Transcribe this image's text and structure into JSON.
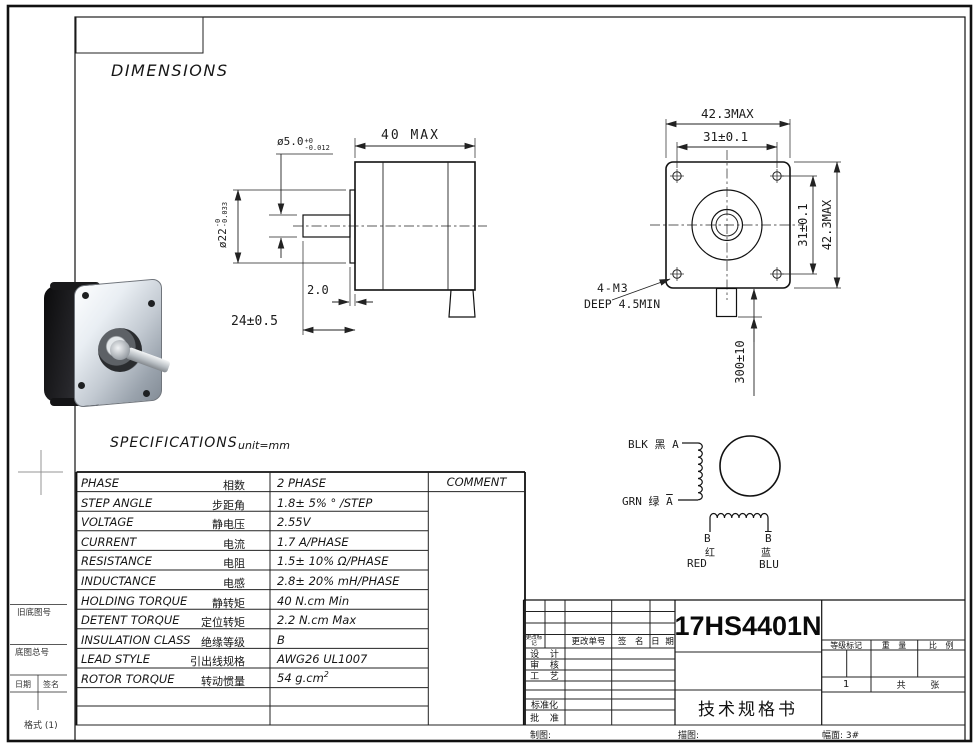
{
  "page": {
    "dimensions_title": "DIMENSIONS",
    "specifications_title": "SPECIFICATIONS",
    "unit_label": "unit=mm",
    "line_color": "#111111"
  },
  "margin": {
    "old_base_no": "旧底图号",
    "base_total_no": "底图总号",
    "date": "日期",
    "sign": "签名",
    "format": "格式 (1)"
  },
  "side_view": {
    "shaft_dia": "ø5.0",
    "shaft_dia_tol_up": "+0",
    "shaft_dia_tol_dn": "-0.012",
    "body_length": "40 MAX",
    "boss_dia": "ø22",
    "boss_dia_tol_up": "-0",
    "boss_dia_tol_dn": "-0.033",
    "boss_height": "2.0",
    "shaft_length": "24±0.5"
  },
  "front_view": {
    "width_max": "42.3MAX",
    "hole_pitch_h": "31±0.1",
    "hole_pitch_v": "31±0.1",
    "height_max": "42.3MAX",
    "lead_length": "300±10",
    "mount_hole": "4-M3",
    "mount_depth": "DEEP 4.5MIN"
  },
  "wiring": {
    "phase_a": "BLK 黑 A",
    "grn_label": "GRN 绿",
    "grn_phase": "A",
    "b_label": "B",
    "b_bar_label": "B",
    "b_cn": "红",
    "b_bar_cn": "蓝",
    "b_en": "RED",
    "b_bar_en": "BLU"
  },
  "spec_table": {
    "comment_header": "COMMENT",
    "rows": [
      {
        "en": "PHASE",
        "cn": "相数",
        "value": "2  PHASE"
      },
      {
        "en": "STEP ANGLE",
        "cn": "步距角",
        "value": "1.8± 5% ° /STEP"
      },
      {
        "en": "VOLTAGE",
        "cn": "静电压",
        "value": "2.55V"
      },
      {
        "en": "CURRENT",
        "cn": "电流",
        "value": "1.7 A/PHASE"
      },
      {
        "en": "RESISTANCE",
        "cn": "电阻",
        "value": "1.5± 10%  Ω/PHASE"
      },
      {
        "en": "INDUCTANCE",
        "cn": "电感",
        "value": "2.8± 20% mH/PHASE"
      },
      {
        "en": "HOLDING TORQUE",
        "cn": "静转矩",
        "value": "40  N.cm Min"
      },
      {
        "en": "DETENT TORQUE",
        "cn": "定位转矩",
        "value": "2.2 N.cm Max"
      },
      {
        "en": "INSULATION CLASS",
        "cn": "绝缘等级",
        "value": "B"
      },
      {
        "en": "LEAD STYLE",
        "cn": "引出线规格",
        "value": "AWG26 UL1007"
      },
      {
        "en": "ROTOR TORQUE",
        "cn": "转动惯量",
        "value": "54 g.cm",
        "value_sup": "2"
      }
    ]
  },
  "title_block": {
    "part_number": "17HS4401N",
    "doc_title": "技术规格书",
    "change_mark": "更改标记",
    "change_order_no": "更改单号",
    "sign": "签 名",
    "date": "日 期",
    "design": "设 计",
    "review": "审 核",
    "process": "工 艺",
    "standardization": "标准化",
    "approval": "批 准",
    "grade_mark": "等级标记",
    "weight": "重 量",
    "scale": "比 例",
    "sheet_no": "1",
    "sheet_total": "共 张",
    "draw_label": "制图:",
    "trace_label": "描图:",
    "sheet_size": "幅面: 3#"
  }
}
